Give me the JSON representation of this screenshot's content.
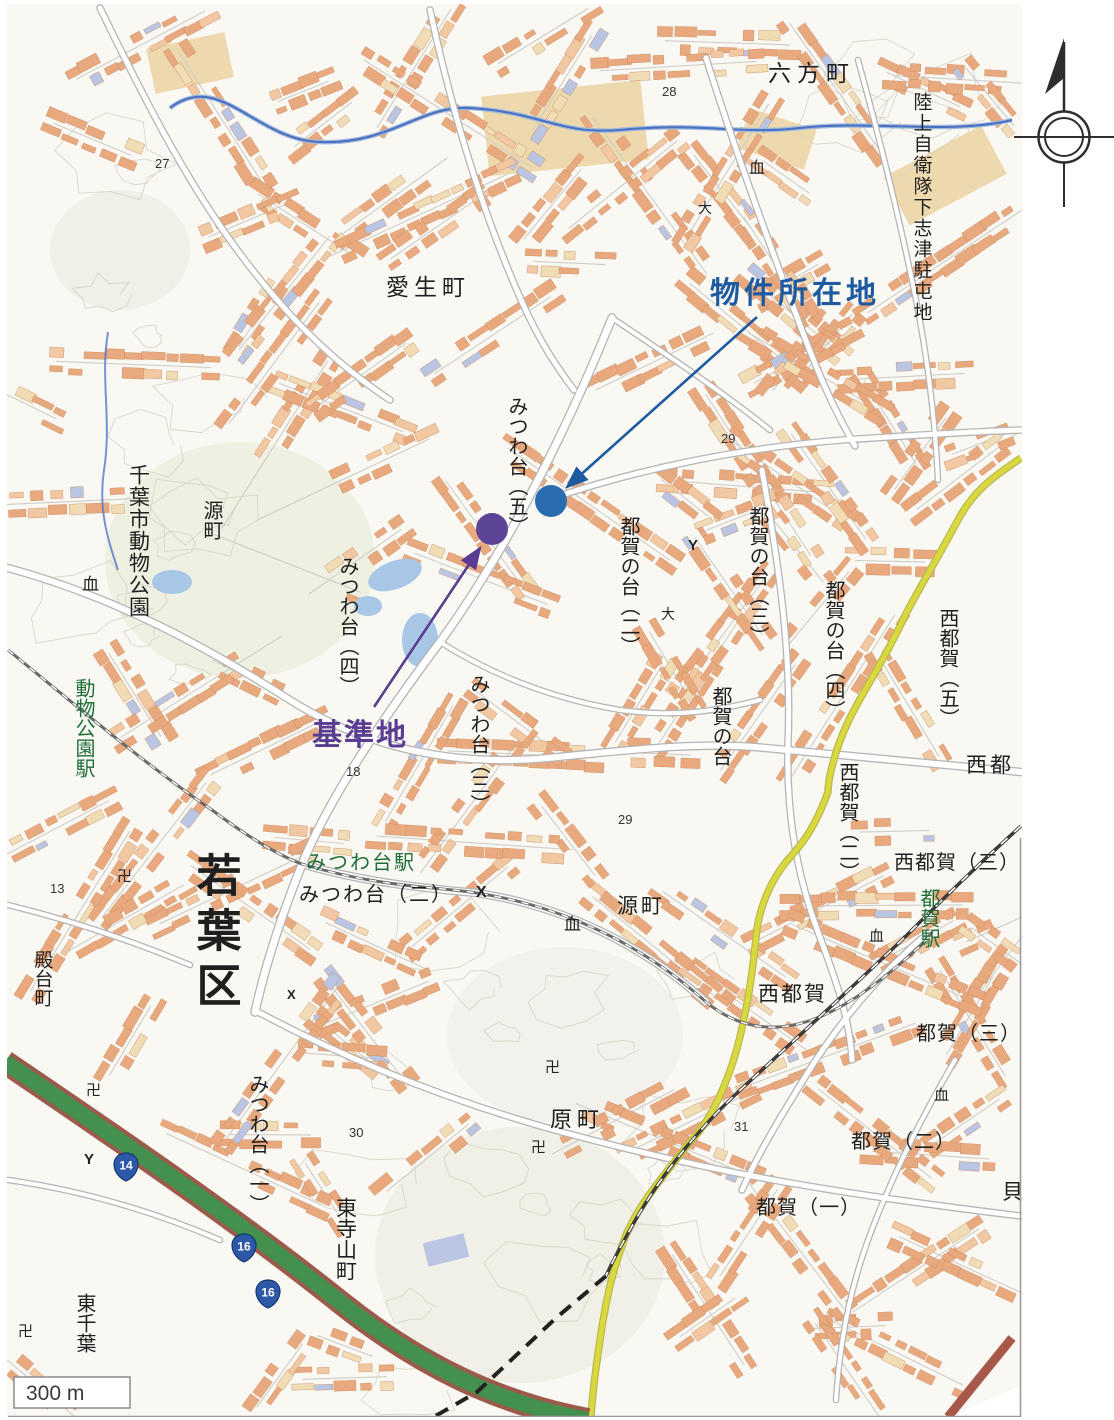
{
  "annotations": {
    "property": {
      "label": "物件所在地",
      "color": "#1d5aa0",
      "dot_color": "#2b6cb0",
      "label_x": 710,
      "label_y": 303,
      "font_size": 30,
      "letter_spacing": 4,
      "arrow": {
        "x1": 757,
        "y1": 317,
        "x2": 567,
        "y2": 487
      },
      "dot": {
        "cx": 551,
        "cy": 501,
        "r": 16
      }
    },
    "benchmark": {
      "label": "基準地",
      "color": "#5a3d91",
      "dot_color": "#5c4496",
      "label_x": 312,
      "label_y": 745,
      "font_size": 30,
      "letter_spacing": 2,
      "arrow": {
        "x1": 374,
        "y1": 707,
        "x2": 480,
        "y2": 548
      },
      "dot": {
        "cx": 492,
        "cy": 529,
        "r": 16
      }
    }
  },
  "scale_bar": {
    "label": "300 m"
  },
  "map": {
    "station_color": "#1f6e38",
    "labels": [
      {
        "text": "六方町",
        "x": 768,
        "y": 81,
        "size": 23,
        "ls": 6
      },
      {
        "text": "陸上自衛隊下志津駐屯地",
        "x": 921,
        "y": 92,
        "size": 19,
        "vertical": true,
        "ls": 2
      },
      {
        "text": "愛生町",
        "x": 386,
        "y": 295,
        "size": 23,
        "ls": 5
      },
      {
        "text": "みつわ台︵五︶",
        "x": 516,
        "y": 396,
        "size": 20,
        "vertical": true
      },
      {
        "text": "都賀の台︵二︶",
        "x": 628,
        "y": 516,
        "size": 20,
        "vertical": true
      },
      {
        "text": "都賀の台︵三︶",
        "x": 757,
        "y": 506,
        "size": 20,
        "vertical": true
      },
      {
        "text": "都賀の台︵四︶",
        "x": 833,
        "y": 580,
        "size": 20,
        "vertical": true
      },
      {
        "text": "都賀の台",
        "x": 720,
        "y": 686,
        "size": 20,
        "vertical": true
      },
      {
        "text": "西都賀︵五︶",
        "x": 947,
        "y": 608,
        "size": 20,
        "vertical": true
      },
      {
        "text": "西都",
        "x": 966,
        "y": 772,
        "size": 21,
        "ls": 3
      },
      {
        "text": "西都賀︵二︶",
        "x": 847,
        "y": 762,
        "size": 20,
        "vertical": true
      },
      {
        "text": "西都賀（三）",
        "x": 894,
        "y": 869,
        "size": 20,
        "ls": 1
      },
      {
        "text": "都賀駅",
        "x": 928,
        "y": 888,
        "size": 20,
        "vertical": true,
        "color": "green"
      },
      {
        "text": "西都賀",
        "x": 758,
        "y": 1001,
        "size": 21,
        "ls": 2
      },
      {
        "text": "都賀（三）",
        "x": 916,
        "y": 1040,
        "size": 20,
        "ls": 1
      },
      {
        "text": "都賀（二）",
        "x": 851,
        "y": 1148,
        "size": 20,
        "ls": 1
      },
      {
        "text": "都賀（一）",
        "x": 756,
        "y": 1214,
        "size": 20,
        "ls": 1
      },
      {
        "text": "貝",
        "x": 1002,
        "y": 1199,
        "size": 21
      },
      {
        "text": "源町",
        "x": 211,
        "y": 500,
        "size": 20,
        "vertical": true
      },
      {
        "text": "源町",
        "x": 617,
        "y": 913,
        "size": 21,
        "ls": 3
      },
      {
        "text": "原町",
        "x": 550,
        "y": 1127,
        "size": 22,
        "ls": 5
      },
      {
        "text": "東寺山町",
        "x": 345,
        "y": 1197,
        "size": 21,
        "vertical": true
      },
      {
        "text": "東千葉",
        "x": 84,
        "y": 1293,
        "size": 20,
        "vertical": true
      },
      {
        "text": "殿台町",
        "x": 42,
        "y": 950,
        "size": 19,
        "vertical": true
      },
      {
        "text": "若葉区",
        "x": 215,
        "y": 852,
        "size": 45,
        "vertical": true,
        "ls": 10,
        "bold": true
      },
      {
        "text": "千葉市動物公園",
        "x": 138,
        "y": 464,
        "size": 21,
        "vertical": true,
        "ls": 1
      },
      {
        "text": "動物公園駅",
        "x": 83,
        "y": 678,
        "size": 20,
        "vertical": true,
        "color": "green"
      },
      {
        "text": "みつわ台駅",
        "x": 306,
        "y": 869,
        "size": 20,
        "color": "green",
        "ls": 2
      },
      {
        "text": "みつわ台（二）",
        "x": 299,
        "y": 901,
        "size": 20,
        "ls": 2
      },
      {
        "text": "みつわ台︵四︶",
        "x": 347,
        "y": 556,
        "size": 20,
        "vertical": true
      },
      {
        "text": "みつわ台︵三︶",
        "x": 478,
        "y": 674,
        "size": 20,
        "vertical": true
      },
      {
        "text": "みつわ台︵一︶",
        "x": 257,
        "y": 1074,
        "size": 20,
        "vertical": true
      }
    ],
    "spot_elevations": [
      {
        "text": "27",
        "x": 155,
        "y": 168
      },
      {
        "text": "28",
        "x": 662,
        "y": 96
      },
      {
        "text": "29",
        "x": 721,
        "y": 443
      },
      {
        "text": "18",
        "x": 346,
        "y": 776
      },
      {
        "text": "29",
        "x": 618,
        "y": 824
      },
      {
        "text": "30",
        "x": 349,
        "y": 1137
      },
      {
        "text": "13",
        "x": 50,
        "y": 893
      },
      {
        "text": "31",
        "x": 734,
        "y": 1131
      }
    ],
    "symbols": [
      {
        "text": "卍",
        "x": 86,
        "y": 1095,
        "size": 15
      },
      {
        "text": "卍",
        "x": 117,
        "y": 881,
        "size": 15
      },
      {
        "text": "卍",
        "x": 531,
        "y": 1152,
        "size": 15
      },
      {
        "text": "卍",
        "x": 18,
        "y": 1336,
        "size": 15
      },
      {
        "text": "卍",
        "x": 545,
        "y": 1072,
        "size": 15
      },
      {
        "text": "血",
        "x": 82,
        "y": 590,
        "size": 17
      },
      {
        "text": "血",
        "x": 749,
        "y": 173,
        "size": 16
      },
      {
        "text": "血",
        "x": 564,
        "y": 930,
        "size": 17
      },
      {
        "text": "血",
        "x": 934,
        "y": 1100,
        "size": 15
      },
      {
        "text": "血",
        "x": 869,
        "y": 941,
        "size": 15
      },
      {
        "text": "X",
        "x": 476,
        "y": 897,
        "size": 16,
        "bold": true
      },
      {
        "text": "X",
        "x": 287,
        "y": 999,
        "size": 13,
        "bold": true
      },
      {
        "text": "Y",
        "x": 688,
        "y": 550,
        "size": 15,
        "bold": true
      },
      {
        "text": "Y",
        "x": 84,
        "y": 1164,
        "size": 15,
        "bold": true
      },
      {
        "text": "大",
        "x": 698,
        "y": 213,
        "size": 14
      },
      {
        "text": "大",
        "x": 661,
        "y": 619,
        "size": 14
      }
    ],
    "route_shields": [
      {
        "num": "14",
        "x": 126,
        "y": 1166
      },
      {
        "num": "16",
        "x": 244,
        "y": 1247
      },
      {
        "num": "16",
        "x": 268,
        "y": 1293
      }
    ]
  },
  "palette": {
    "building": "#e9a97e",
    "building_light": "#f2c8a2",
    "building_tan": "#f0ddb5",
    "building_blue": "#b9c5e2",
    "road_casing": "#b5b5b5",
    "yellow_road": "#d9d93f",
    "expressway_green": "#44904f",
    "expressway_edge": "#9c5a4c",
    "river": "#4a6fc0",
    "shield_blue": "#2d59a8",
    "station_green": "#1f6e38",
    "annotation_blue": "#1d5aa0",
    "annotation_purple": "#5a3d91",
    "label_black": "#1f1f1f"
  }
}
